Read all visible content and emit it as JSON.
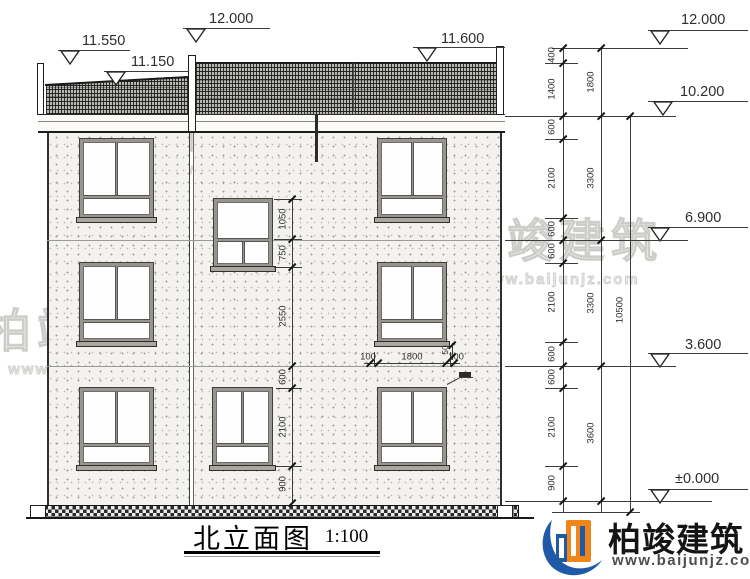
{
  "title": {
    "text": "北立面图",
    "scale": "1:100"
  },
  "elevations": {
    "left": [
      "11.550",
      "11.150",
      "12.000",
      "11.600"
    ],
    "right": [
      "12.000",
      "10.200",
      "6.900",
      "3.600",
      "±0.000"
    ]
  },
  "dims": {
    "chain1": [
      "400",
      "1400",
      "600",
      "2100",
      "600",
      "600",
      "2100",
      "600",
      "600",
      "2100",
      "900"
    ],
    "chain2": [
      "1800",
      "3300",
      "3300",
      "3600"
    ],
    "chain3": [
      "10500"
    ],
    "interior": [
      "1050",
      "750",
      "2550",
      "600",
      "2100",
      "900"
    ],
    "window_width": [
      "100",
      "1800",
      "100"
    ],
    "sill": "50"
  },
  "logo": {
    "name": "柏竣建筑",
    "url": "www.baijunjz.com"
  },
  "watermark": {
    "text": "柏竣建筑",
    "url": "www.baijunjz.com"
  }
}
